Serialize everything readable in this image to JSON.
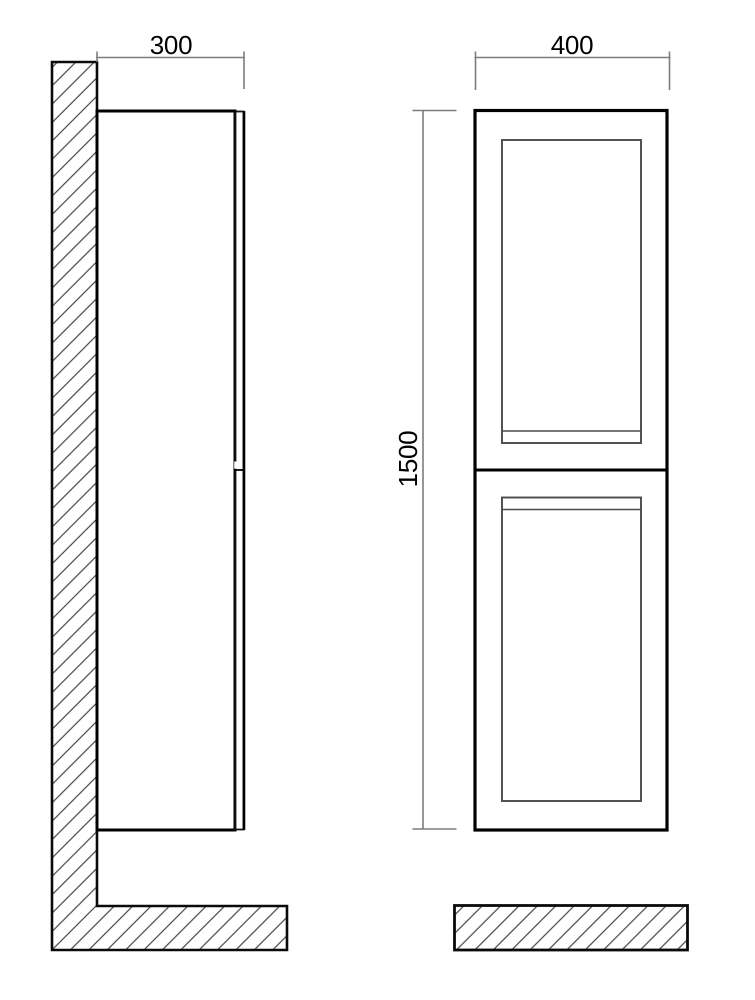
{
  "drawing": {
    "side_view": {
      "depth_label": "300"
    },
    "front_view": {
      "width_label": "400",
      "height_label": "1500"
    }
  },
  "colors": {
    "outline": "#000000",
    "panel_line": "#4a4a4a",
    "dimension_line": "#7d7d7d",
    "hatch_line": "#454545",
    "background": "#ffffff"
  }
}
